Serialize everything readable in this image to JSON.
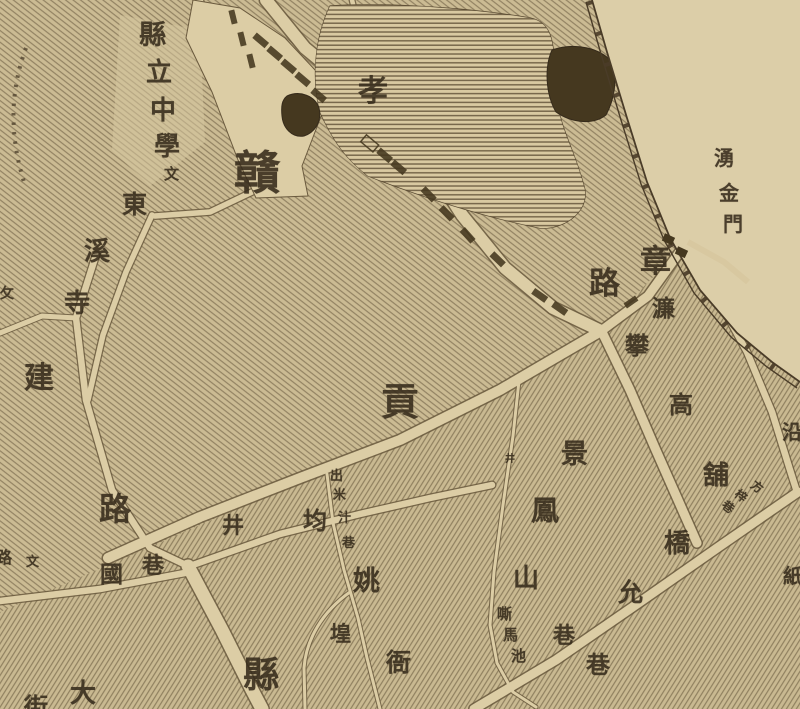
{
  "map": {
    "type": "historical-city-map",
    "city_hint": "贛州",
    "palette": {
      "paper": "#d8c8a0",
      "block_fill": "#cbbb93",
      "hatch_line": "#5a4a31",
      "road_fill": "#dccda5",
      "road_edge": "#6a5a3e",
      "ink": "#362b1b",
      "water_dark": "#45381f",
      "outside_wall": "#dccea8"
    },
    "features": [
      {
        "name": "lake",
        "style": "horizontal-line shading"
      },
      {
        "name": "pond-east",
        "style": "solid dark"
      },
      {
        "name": "pond-west",
        "style": "solid dark"
      },
      {
        "name": "city-wall",
        "style": "double line with ticks"
      },
      {
        "name": "gate",
        "label": "湧金門"
      },
      {
        "name": "well-symbol",
        "glyph": "井"
      }
    ],
    "labels": [
      {
        "name": "county-middle-school",
        "text": "縣立中學文",
        "chars": [
          {
            "t": "縣",
            "x": 139,
            "y": 22,
            "s": 27
          },
          {
            "t": "立",
            "x": 146,
            "y": 60,
            "s": 26
          },
          {
            "t": "中",
            "x": 150,
            "y": 98,
            "s": 26
          },
          {
            "t": "學",
            "x": 154,
            "y": 134,
            "s": 26
          },
          {
            "t": "文",
            "x": 164,
            "y": 168,
            "s": 15
          }
        ]
      },
      {
        "name": "dongxi-temple",
        "text": "東溪寺",
        "chars": [
          {
            "t": "東",
            "x": 122,
            "y": 193,
            "s": 25
          },
          {
            "t": "溪",
            "x": 84,
            "y": 239,
            "s": 26
          },
          {
            "t": "寺",
            "x": 64,
            "y": 291,
            "s": 26
          }
        ]
      },
      {
        "name": "gan-char",
        "text": "贛",
        "chars": [
          {
            "t": "贛",
            "x": 234,
            "y": 151,
            "s": 46
          }
        ]
      },
      {
        "name": "xiao-char",
        "text": "孝",
        "chars": [
          {
            "t": "孝",
            "x": 358,
            "y": 77,
            "s": 30
          }
        ]
      },
      {
        "name": "yongjin-gate",
        "text": "湧金門",
        "chars": [
          {
            "t": "湧",
            "x": 714,
            "y": 149,
            "s": 20
          },
          {
            "t": "金",
            "x": 719,
            "y": 184,
            "s": 20
          },
          {
            "t": "門",
            "x": 723,
            "y": 215,
            "s": 20
          }
        ]
      },
      {
        "name": "zhang-lu-road",
        "text": "章路",
        "chars": [
          {
            "t": "章",
            "x": 640,
            "y": 246,
            "s": 31
          },
          {
            "t": "路",
            "x": 589,
            "y": 268,
            "s": 31
          }
        ]
      },
      {
        "name": "lian-char",
        "text": "濂",
        "chars": [
          {
            "t": "濂",
            "x": 652,
            "y": 297,
            "s": 23
          }
        ]
      },
      {
        "name": "pangaopu-street",
        "text": "攀高舖",
        "chars": [
          {
            "t": "攀",
            "x": 625,
            "y": 335,
            "s": 24
          },
          {
            "t": "高",
            "x": 669,
            "y": 394,
            "s": 24
          },
          {
            "t": "舖",
            "x": 703,
            "y": 463,
            "s": 26
          }
        ]
      },
      {
        "name": "fangzi-lane-small",
        "text": "方梓巷",
        "chars": [
          {
            "t": "方",
            "x": 751,
            "y": 481,
            "s": 12,
            "r": 38
          },
          {
            "t": "梓",
            "x": 735,
            "y": 490,
            "s": 12,
            "r": 38
          },
          {
            "t": "巷",
            "x": 722,
            "y": 501,
            "s": 12,
            "r": 38
          }
        ]
      },
      {
        "name": "gong-char",
        "text": "貢",
        "chars": [
          {
            "t": "貢",
            "x": 381,
            "y": 384,
            "s": 38
          }
        ]
      },
      {
        "name": "jing-char",
        "text": "景",
        "chars": [
          {
            "t": "景",
            "x": 561,
            "y": 441,
            "s": 27
          }
        ]
      },
      {
        "name": "fengshan-lane",
        "text": "鳳山巷",
        "chars": [
          {
            "t": "鳳",
            "x": 531,
            "y": 498,
            "s": 28
          },
          {
            "t": "山",
            "x": 513,
            "y": 566,
            "s": 26
          },
          {
            "t": "巷",
            "x": 553,
            "y": 625,
            "s": 22
          }
        ]
      },
      {
        "name": "simachi",
        "text": "嘶馬池",
        "chars": [
          {
            "t": "嘶",
            "x": 497,
            "y": 608,
            "s": 15
          },
          {
            "t": "馬",
            "x": 503,
            "y": 629,
            "s": 15
          },
          {
            "t": "池",
            "x": 511,
            "y": 650,
            "s": 15
          }
        ]
      },
      {
        "name": "qiaoyun-lane",
        "text": "橋允巷",
        "chars": [
          {
            "t": "橋",
            "x": 664,
            "y": 531,
            "s": 26
          },
          {
            "t": "允",
            "x": 618,
            "y": 581,
            "s": 25
          },
          {
            "t": "巷",
            "x": 586,
            "y": 654,
            "s": 24
          }
        ]
      },
      {
        "name": "jianguo-road",
        "text": "建路",
        "chars": [
          {
            "t": "建",
            "x": 24,
            "y": 364,
            "s": 30
          },
          {
            "t": "路",
            "x": 99,
            "y": 493,
            "s": 32
          }
        ]
      },
      {
        "name": "junjing-lane",
        "text": "均井巷國",
        "chars": [
          {
            "t": "均",
            "x": 303,
            "y": 510,
            "s": 24
          },
          {
            "t": "井",
            "x": 222,
            "y": 515,
            "s": 22
          },
          {
            "t": "巷",
            "x": 142,
            "y": 555,
            "s": 22
          },
          {
            "t": "國",
            "x": 100,
            "y": 563,
            "s": 23
          }
        ]
      },
      {
        "name": "edge-left-small",
        "text": "路文",
        "chars": [
          {
            "t": "路",
            "x": -4,
            "y": 551,
            "s": 16
          },
          {
            "t": "文",
            "x": 26,
            "y": 555,
            "s": 13
          }
        ]
      },
      {
        "name": "edge-left-pu",
        "text": "攵",
        "chars": [
          {
            "t": "攵",
            "x": 0,
            "y": 288,
            "s": 14
          }
        ]
      },
      {
        "name": "chumizhi-lane",
        "text": "出米汁巷",
        "chars": [
          {
            "t": "出",
            "x": 330,
            "y": 469,
            "s": 13
          },
          {
            "t": "米",
            "x": 333,
            "y": 488,
            "s": 13
          },
          {
            "t": "汁",
            "x": 338,
            "y": 511,
            "s": 13
          },
          {
            "t": "巷",
            "x": 342,
            "y": 536,
            "s": 13
          }
        ]
      },
      {
        "name": "yao-char",
        "text": "姚",
        "chars": [
          {
            "t": "姚",
            "x": 353,
            "y": 568,
            "s": 27
          }
        ]
      },
      {
        "name": "huang-char",
        "text": "堭",
        "chars": [
          {
            "t": "堭",
            "x": 330,
            "y": 624,
            "s": 21
          }
        ]
      },
      {
        "name": "ya-char",
        "text": "衙",
        "chars": [
          {
            "t": "衙",
            "x": 386,
            "y": 651,
            "s": 25
          }
        ]
      },
      {
        "name": "xian-char",
        "text": "縣",
        "chars": [
          {
            "t": "縣",
            "x": 243,
            "y": 657,
            "s": 36
          }
        ]
      },
      {
        "name": "da-street",
        "text": "大街",
        "chars": [
          {
            "t": "大",
            "x": 70,
            "y": 681,
            "s": 26
          },
          {
            "t": "街",
            "x": 24,
            "y": 696,
            "s": 24
          }
        ]
      },
      {
        "name": "edge-right-yan",
        "text": "沿",
        "chars": [
          {
            "t": "沿",
            "x": 782,
            "y": 423,
            "s": 20
          }
        ]
      },
      {
        "name": "edge-right-zhi",
        "text": "紙",
        "chars": [
          {
            "t": "紙",
            "x": 783,
            "y": 567,
            "s": 20
          }
        ]
      },
      {
        "name": "well-symbol",
        "text": "井",
        "chars": [
          {
            "t": "井",
            "x": 505,
            "y": 455,
            "s": 10
          }
        ]
      }
    ]
  }
}
